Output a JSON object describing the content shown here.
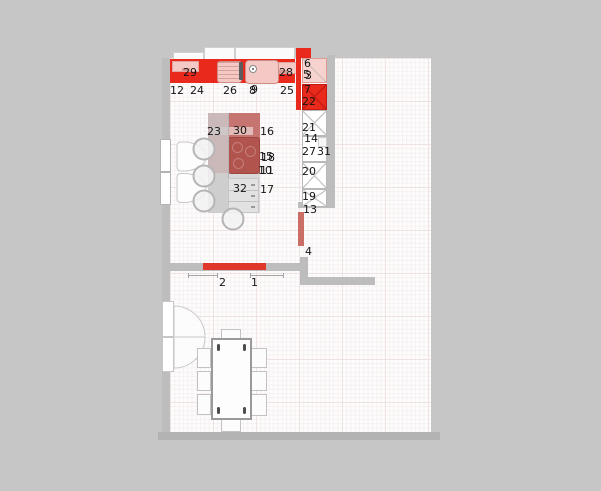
{
  "canvas": {
    "width": 601,
    "height": 491
  },
  "colors": {
    "background": "#c6c6c6",
    "floor": "#fdfdfd",
    "grid_light": "#f7f0f0",
    "grid_strong": "#eee2e2",
    "wall": "#bdbdbd",
    "wall_dark": "#b3b3b3",
    "accent_red": "#e8291c",
    "panel_pink": "#f4c9c5",
    "corner_pink": "#f7d3cf",
    "island_red": "#c57470",
    "cooktop_red": "#b2544e",
    "island_gray": "#d9d9d9",
    "worktop_red": "#e0372a",
    "radiator_red": "#cb6e66",
    "cross_line": "#c9c9c9",
    "label": "#151515"
  },
  "item_labels": [
    {
      "text": "29",
      "x": 183,
      "y": 67
    },
    {
      "text": "28",
      "x": 279,
      "y": 67
    },
    {
      "text": "12",
      "x": 170,
      "y": 85
    },
    {
      "text": "24",
      "x": 190,
      "y": 85
    },
    {
      "text": "26",
      "x": 223,
      "y": 85
    },
    {
      "text": "8",
      "x": 249,
      "y": 85
    },
    {
      "text": "9",
      "x": 251,
      "y": 84
    },
    {
      "text": "25",
      "x": 280,
      "y": 85
    },
    {
      "text": "6",
      "x": 304,
      "y": 58
    },
    {
      "text": "5",
      "x": 303,
      "y": 69
    },
    {
      "text": "3",
      "x": 305,
      "y": 70
    },
    {
      "text": "7",
      "x": 304,
      "y": 84
    },
    {
      "text": "22",
      "x": 302,
      "y": 96
    },
    {
      "text": "21",
      "x": 302,
      "y": 122
    },
    {
      "text": "14",
      "x": 304,
      "y": 133
    },
    {
      "text": "27",
      "x": 302,
      "y": 146
    },
    {
      "text": "31",
      "x": 317,
      "y": 146
    },
    {
      "text": "20",
      "x": 302,
      "y": 166
    },
    {
      "text": "19",
      "x": 302,
      "y": 191
    },
    {
      "text": "13",
      "x": 303,
      "y": 204
    },
    {
      "text": "4",
      "x": 305,
      "y": 246
    },
    {
      "text": "23",
      "x": 207,
      "y": 126
    },
    {
      "text": "30",
      "x": 233,
      "y": 125
    },
    {
      "text": "16",
      "x": 260,
      "y": 126
    },
    {
      "text": "15",
      "x": 259,
      "y": 151
    },
    {
      "text": "18",
      "x": 261,
      "y": 152
    },
    {
      "text": "10",
      "x": 258,
      "y": 165
    },
    {
      "text": "11",
      "x": 260,
      "y": 165
    },
    {
      "text": "32",
      "x": 233,
      "y": 183
    },
    {
      "text": "17",
      "x": 260,
      "y": 184
    },
    {
      "text": "2",
      "x": 219,
      "y": 277
    },
    {
      "text": "1",
      "x": 251,
      "y": 277
    }
  ]
}
